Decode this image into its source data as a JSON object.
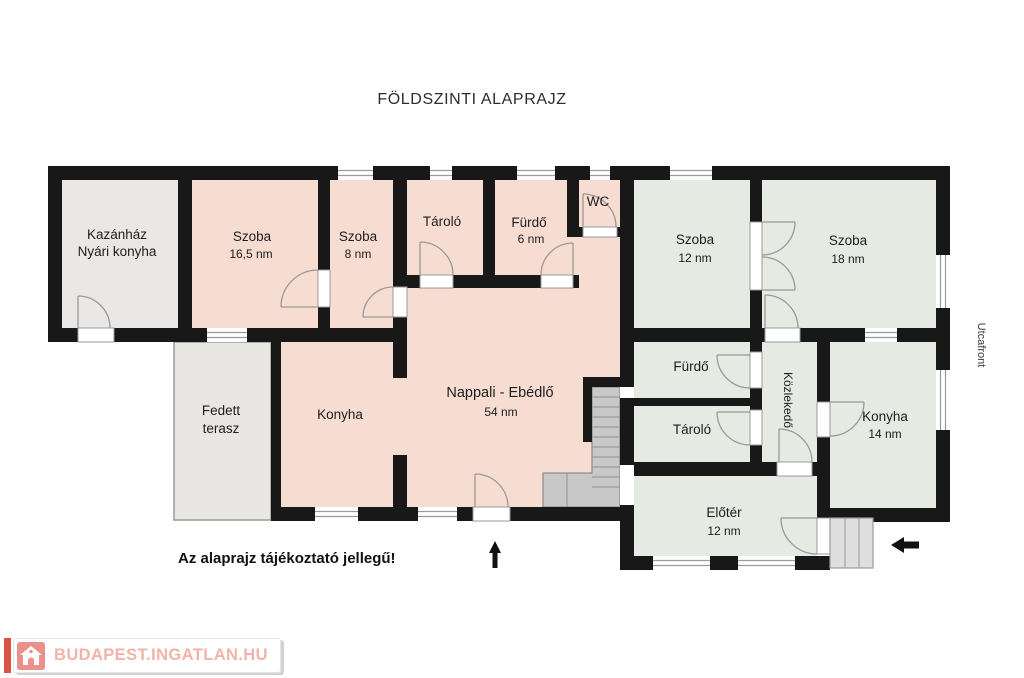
{
  "title": "FÖLDSZINTI ALAPRAJZ",
  "disclaimer": "Az alaprajz tájékoztató jellegű!",
  "street_side_label": "Utcafront",
  "icons": {
    "north_arrow": "arrow-up",
    "entrance_arrow": "arrow-left",
    "logo_house": "house-icon"
  },
  "logo": {
    "text": "BUDAPEST.INGATLAN.HU"
  },
  "colors": {
    "wall": "#181818",
    "room_pink": "#f7dcd1",
    "room_green": "#e5eae3",
    "room_gray": "#eae8e7",
    "terrace_gray": "#e9e7e4",
    "stairs_fill": "#c8c8c8",
    "door_stroke": "#999999",
    "logo_bar_red": "#dd5348",
    "logo_house_red": "#ea9289",
    "logo_text_pink": "#f2b3a8"
  },
  "rooms": {
    "kazanhaz": {
      "line1": "Kazánház",
      "line2": "Nyári konyha"
    },
    "szoba1": {
      "name": "Szoba",
      "area": "16,5 nm"
    },
    "szoba2": {
      "name": "Szoba",
      "area": "8 nm"
    },
    "tarolo1": {
      "name": "Tároló"
    },
    "furdo1": {
      "name": "Fürdő",
      "area": "6 nm"
    },
    "wc": {
      "name": "WC"
    },
    "szoba3": {
      "name": "Szoba",
      "area": "12 nm"
    },
    "szoba4": {
      "name": "Szoba",
      "area": "18 nm"
    },
    "fedett_terasz": {
      "line1": "Fedett",
      "line2": "terasz"
    },
    "konyha1": {
      "name": "Konyha"
    },
    "nappali": {
      "name": "Nappali - Ebédlő",
      "area": "54 nm"
    },
    "furdo2": {
      "name": "Fürdő"
    },
    "tarolo2": {
      "name": "Tároló"
    },
    "kozlekedo": {
      "name": "Közlekedő"
    },
    "konyha2": {
      "name": "Konyha",
      "area": "14 nm"
    },
    "eloter": {
      "name": "Előtér",
      "area": "12 nm"
    }
  }
}
